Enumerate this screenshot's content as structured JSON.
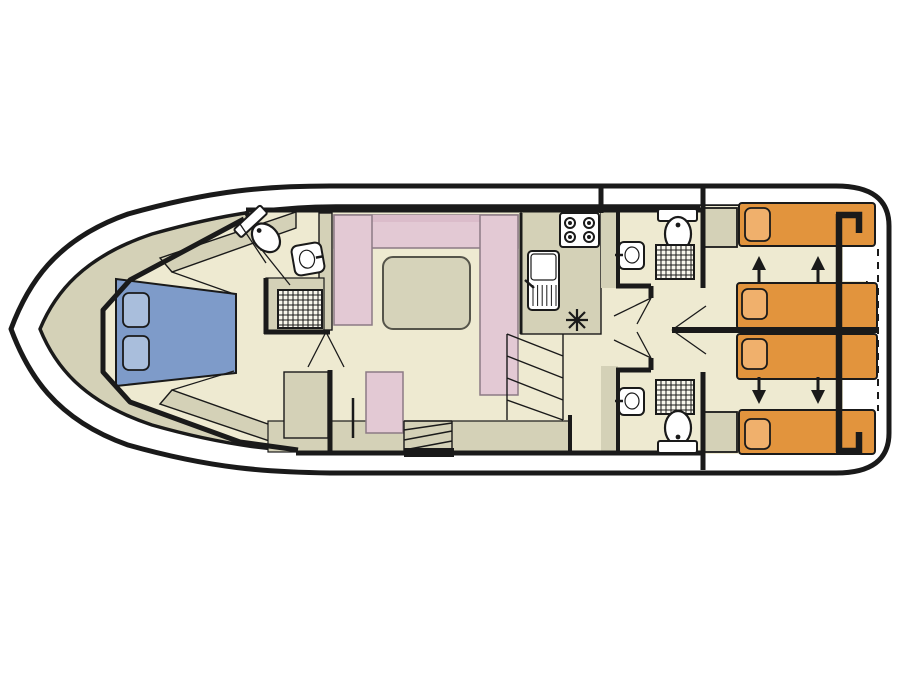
{
  "colors": {
    "hull_fill": "#FFFFFF",
    "outline": "#1A1A1A",
    "deck": "#D4D1B7",
    "floor": "#EEEAD1",
    "sofa_pink": "#E3C9D4",
    "sofa_pink_dark": "#DBBCCA",
    "table_gray": "#D6D3BA",
    "bed_blue": "#7E9BC9",
    "pillow_blue": "#A9BEDC",
    "bed_orange": "#E2943D",
    "pillow_orange": "#F0B06C",
    "fixture_white": "#FFFFFF",
    "shower_bg": "#F8F6EC"
  },
  "inventory": {
    "bow_cabin": [
      "double-bed-blue",
      "two-pillows",
      "ensuite-toilet",
      "ensuite-sink",
      "shower-grid"
    ],
    "salon": [
      "u-shaped-sofa-pink",
      "table",
      "side-chair-pink"
    ],
    "galley": [
      "stove-4-burners",
      "sink-with-drainer",
      "fridge-star-symbol",
      "stairs"
    ],
    "midship": [
      "bathroom-top (toilet, sink, shower)",
      "bathroom-bottom (toilet, sink, shower)",
      "corridor-with-doors"
    ],
    "aft_cabins": [
      "four-single-beds-orange",
      "sliding-bed-arrows",
      "dashed-partition-line"
    ]
  }
}
